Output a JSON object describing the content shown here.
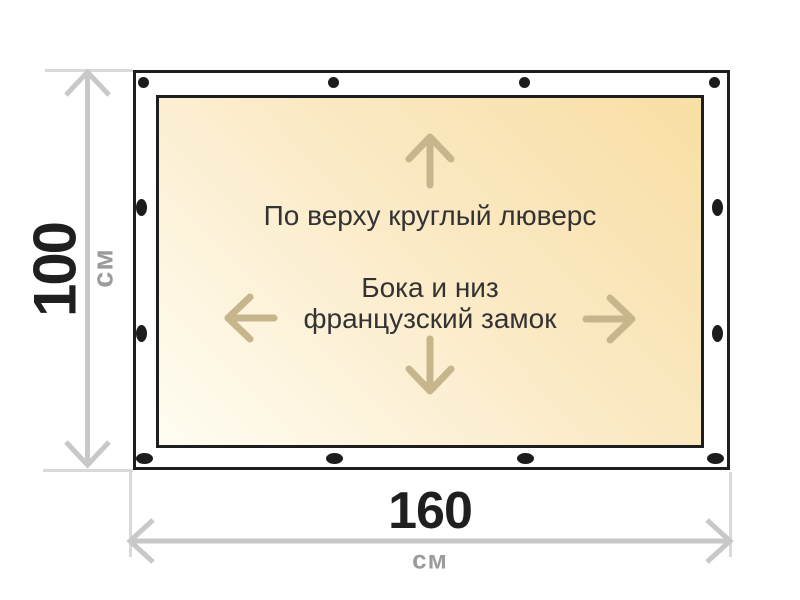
{
  "diagram": {
    "banner": {
      "note_top": "По верху круглый люверс",
      "note_middle_line1": "Бока и низ",
      "note_middle_line2": "французский замок"
    },
    "height_dim": {
      "value": "100",
      "unit": "см"
    },
    "width_dim": {
      "value": "160",
      "unit": "см"
    }
  },
  "icons": {
    "up": "arrow-up-icon",
    "down": "arrow-down-icon",
    "left": "arrow-left-icon",
    "right": "arrow-right-icon",
    "vertical_dimension": "dimension-double-arrow-vertical-icon",
    "horizontal_dimension": "dimension-double-arrow-horizontal-icon",
    "grommet": "grommet-dot"
  },
  "colors": {
    "page_bg": "#ffffff",
    "banner_border": "#1e1e1e",
    "banner_margin_fill": "#ffffff",
    "print_fill_light": "#fffdf2",
    "print_fill_mid": "#fbe9c4",
    "print_fill_dark": "#f8dfa4",
    "inner_arrow_tan": "#c7b58c",
    "dimension_gray": "#c8c8c8",
    "extension_gray": "#d9d9d9",
    "unit_gray": "#9b9b9b",
    "note_text": "#333333",
    "number_black": "#1f1f1f",
    "grommet_black": "#1c1c1c"
  }
}
